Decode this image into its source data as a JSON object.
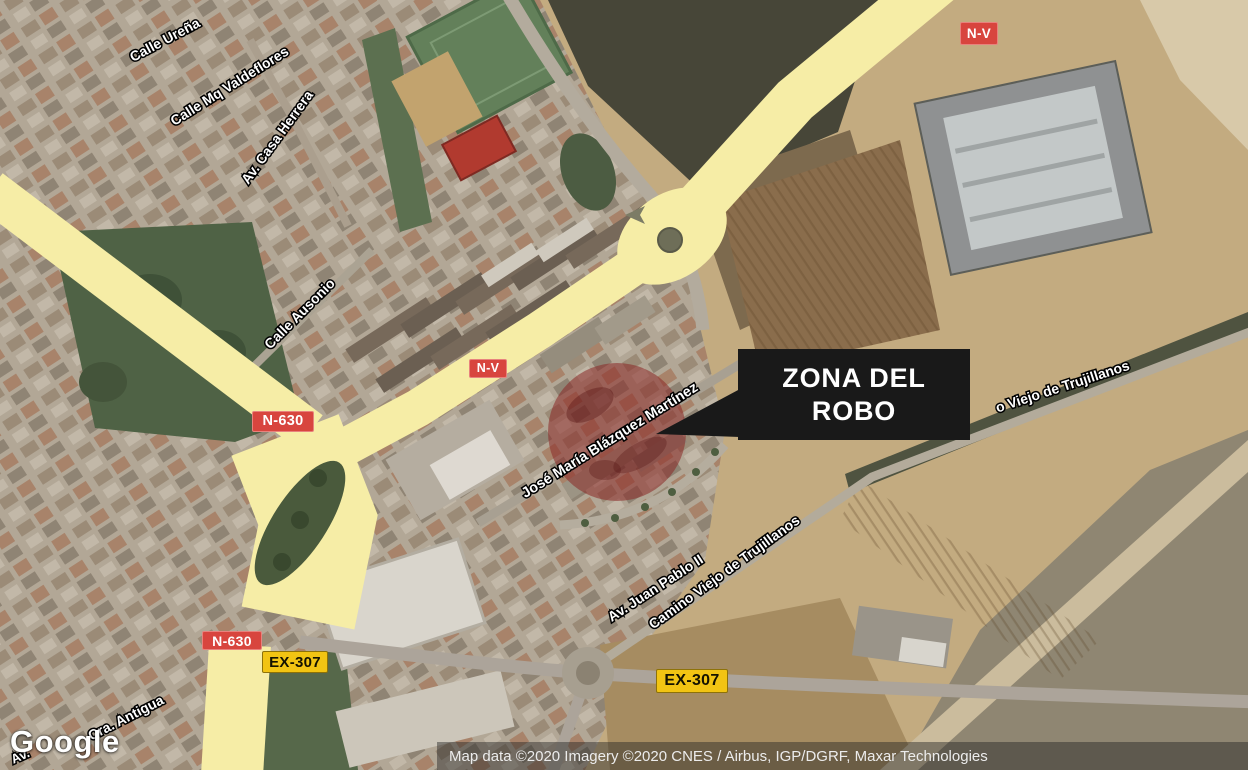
{
  "map": {
    "provider_logo": "Google",
    "attribution": "Map data ©2020 Imagery ©2020 CNES / Airbus, IGP/DGRF, Maxar Technologies",
    "annotation": {
      "zone_label": "ZONA DEL ROBO"
    },
    "road_shields": {
      "nv_top": "N-V",
      "nv_mid": "N-V",
      "n630_top": "N-630",
      "n630_bottom": "N-630",
      "ex307_west": "EX-307",
      "ex307_east": "EX-307"
    },
    "street_labels": {
      "calle_urena": "Calle Ureña",
      "calle_mq_valdeflores": "Calle Mq Valdeflores",
      "av_casa_herrera": "Av. Casa Herrera",
      "calle_ausonio": "Calle Ausonio",
      "jose_maria_blazquez_martinez": "José María Blázquez Martínez",
      "av_juan_pablo_ii": "Av. Juan Pablo II",
      "camino_viejo_de_trujillanos": "Camino Viejo de Trujillanos",
      "camino_viejo_partial": "o Viejo de Trujillanos",
      "cra_antigua": "Cra. Antigua",
      "av_partial": "Av."
    },
    "colors": {
      "highlight_zone": "#8a2826",
      "road_major_yellow": "#f6eda6",
      "shield_red": "#d8453e",
      "shield_yellow": "#f2c413",
      "callout_bg": "#191919"
    }
  }
}
